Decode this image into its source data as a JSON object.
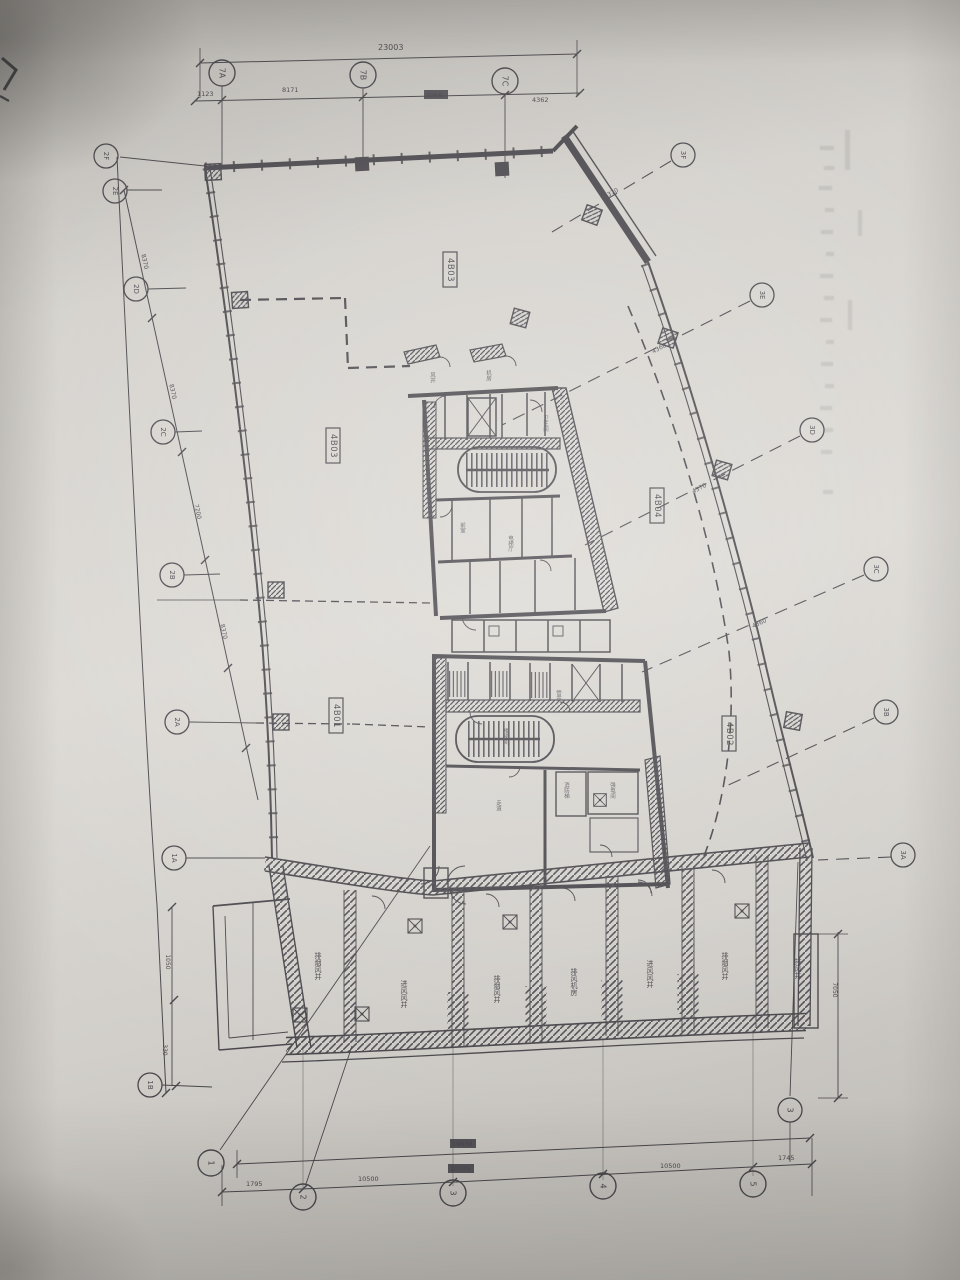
{
  "photo": {
    "paper_color": "#d7d4cf",
    "ink_color": "#3c3a40",
    "description": "photographed architectural floor plan sheet"
  },
  "room_labels": {
    "top": "4B03",
    "west": "4B03",
    "east": "4B04",
    "southwest": "4B01",
    "southeast": "4B02"
  },
  "dims_top": {
    "total": "23003",
    "seg1": "1123",
    "seg2": "8171",
    "seg3": "9068",
    "seg4": "4362"
  },
  "dims_bottom": {
    "total": "19938",
    "seg1": "1795",
    "seg2": "10500",
    "seg3": "10705",
    "seg4": "10500",
    "seg5": "1745"
  },
  "dims_left": {
    "d1": "8370",
    "d2": "8370",
    "d3": "7200",
    "d4": "8370",
    "v1": "1050",
    "v2": "330"
  },
  "dims_right": {
    "d1": "4370",
    "d2": "4360",
    "d3": "4370",
    "d4": "4360",
    "v1": "7050"
  },
  "grid": {
    "top1": "7A",
    "top2": "7B",
    "top3": "7C",
    "left1": "2F",
    "left2": "2E",
    "left3": "2D",
    "left4": "2C",
    "left5": "2B",
    "left6": "2A",
    "left7": "1A",
    "left8": "1B",
    "right1": "3F",
    "right2": "3E",
    "right3": "3D",
    "right4": "3C",
    "right5": "3B",
    "right6": "3A",
    "bottom1": "1",
    "bottom2": "2",
    "bottom3": "3",
    "bottom4": "4",
    "bottom5": "5",
    "bottom_right": "3"
  },
  "plant_rooms": {
    "r1": "排烟风井",
    "r2": "进风风井",
    "r3": "排烟风井",
    "r4": "排风机房",
    "r5": "进风风井",
    "r6": "排烟风井",
    "r7": "排风井"
  },
  "core_rooms": {
    "c1": "电梯厅",
    "c2": "楼梯间",
    "c3": "卫生间",
    "c4": "前室",
    "c5": "管井",
    "c6": "强电间",
    "c8": "消防梯",
    "c9": "走道",
    "c11": "风井",
    "c12": "机房"
  }
}
